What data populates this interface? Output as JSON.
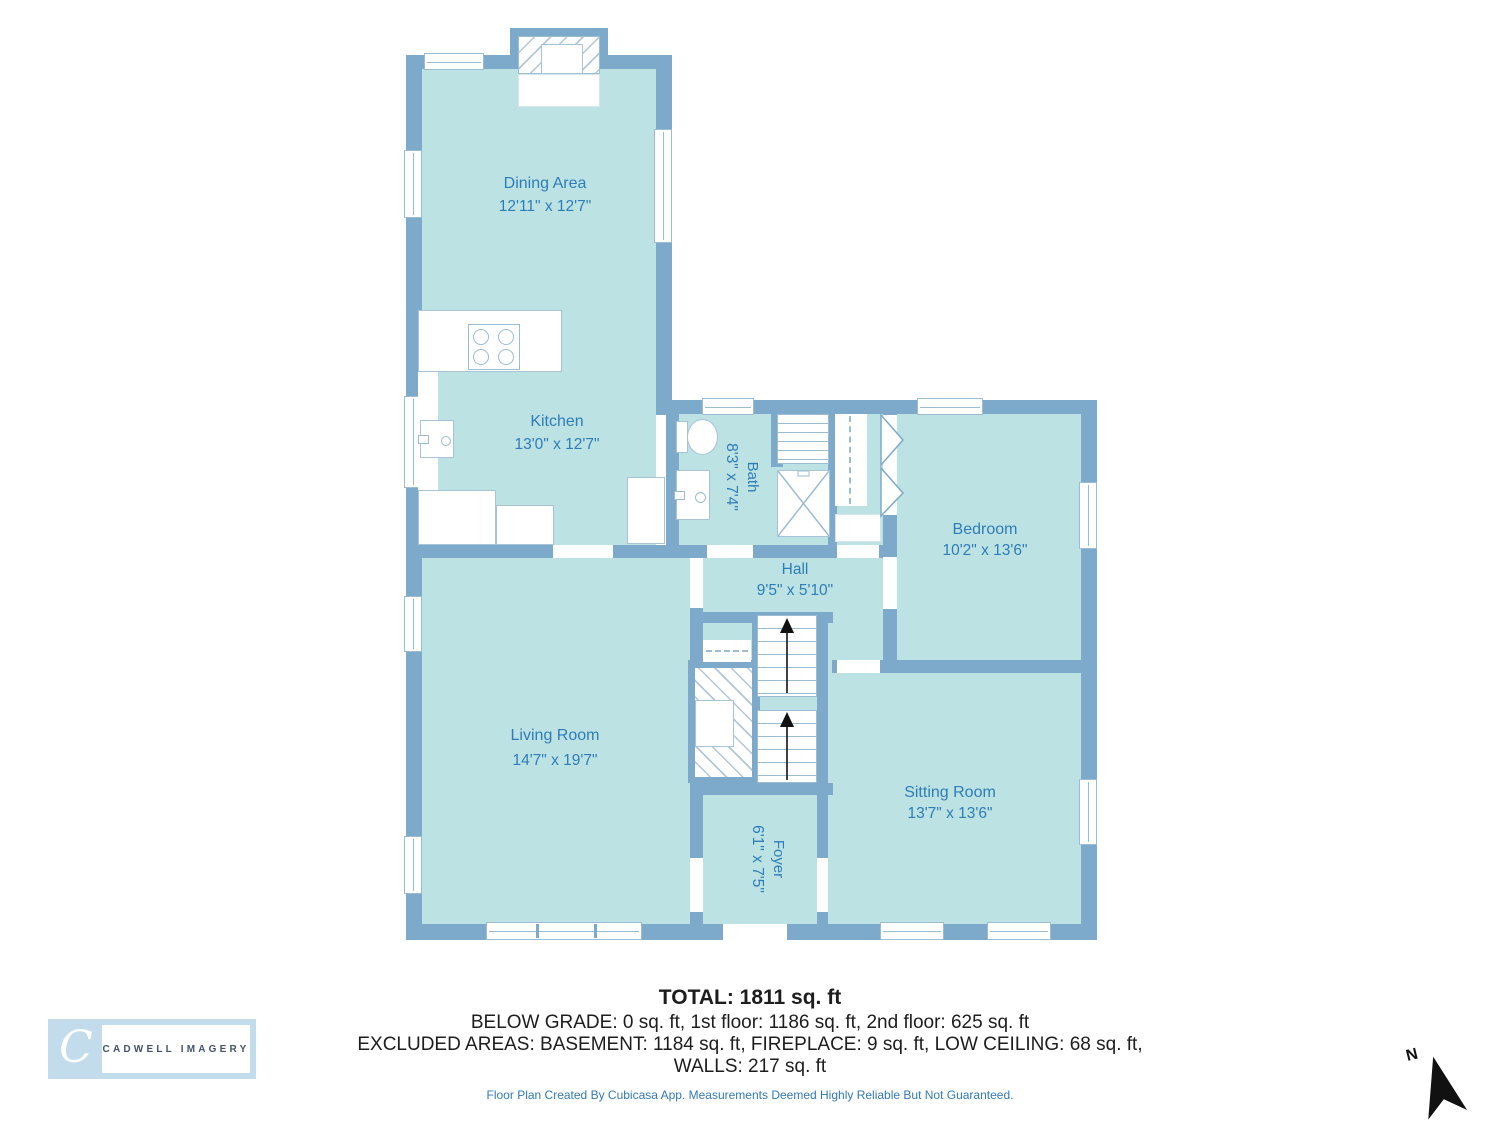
{
  "plan": {
    "rooms": [
      {
        "id": "dining",
        "name": "Dining Area",
        "dims": "12'11\" x 12'7\""
      },
      {
        "id": "kitchen",
        "name": "Kitchen",
        "dims": "13'0\" x 12'7\""
      },
      {
        "id": "bath",
        "name": "Bath",
        "dims": "8'3\" x 7'4\""
      },
      {
        "id": "hall",
        "name": "Hall",
        "dims": "9'5\" x 5'10\""
      },
      {
        "id": "bedroom",
        "name": "Bedroom",
        "dims": "10'2\" x 13'6\""
      },
      {
        "id": "living",
        "name": "Living Room",
        "dims": "14'7\" x 19'7\""
      },
      {
        "id": "sitting",
        "name": "Sitting Room",
        "dims": "13'7\" x 13'6\""
      },
      {
        "id": "foyer",
        "name": "Foyer",
        "dims": "6'1\" x 7'5\""
      }
    ],
    "compass": {
      "label": "N"
    }
  },
  "summary": {
    "total": "TOTAL: 1811 sq. ft",
    "line1": "BELOW GRADE: 0 sq. ft, 1st floor: 1186 sq. ft, 2nd floor: 625 sq. ft",
    "line2": "EXCLUDED AREAS: BASEMENT: 1184 sq. ft, FIREPLACE: 9 sq. ft, LOW CEILING: 68 sq. ft,",
    "line3": "WALLS: 217 sq. ft"
  },
  "footer": {
    "disclaimer": "Floor Plan Created By Cubicasa App. Measurements Deemed Highly Reliable But Not Guaranteed."
  },
  "branding": {
    "logo_monogram": "C",
    "logo_text": "CADWELL IMAGERY"
  },
  "colors": {
    "wall": "#7da9cb",
    "room_fill": "#bce2e3",
    "label_text": "#2e7db8",
    "hatch_line": "#b2c8d8",
    "disclaimer_text": "#3279b7"
  }
}
